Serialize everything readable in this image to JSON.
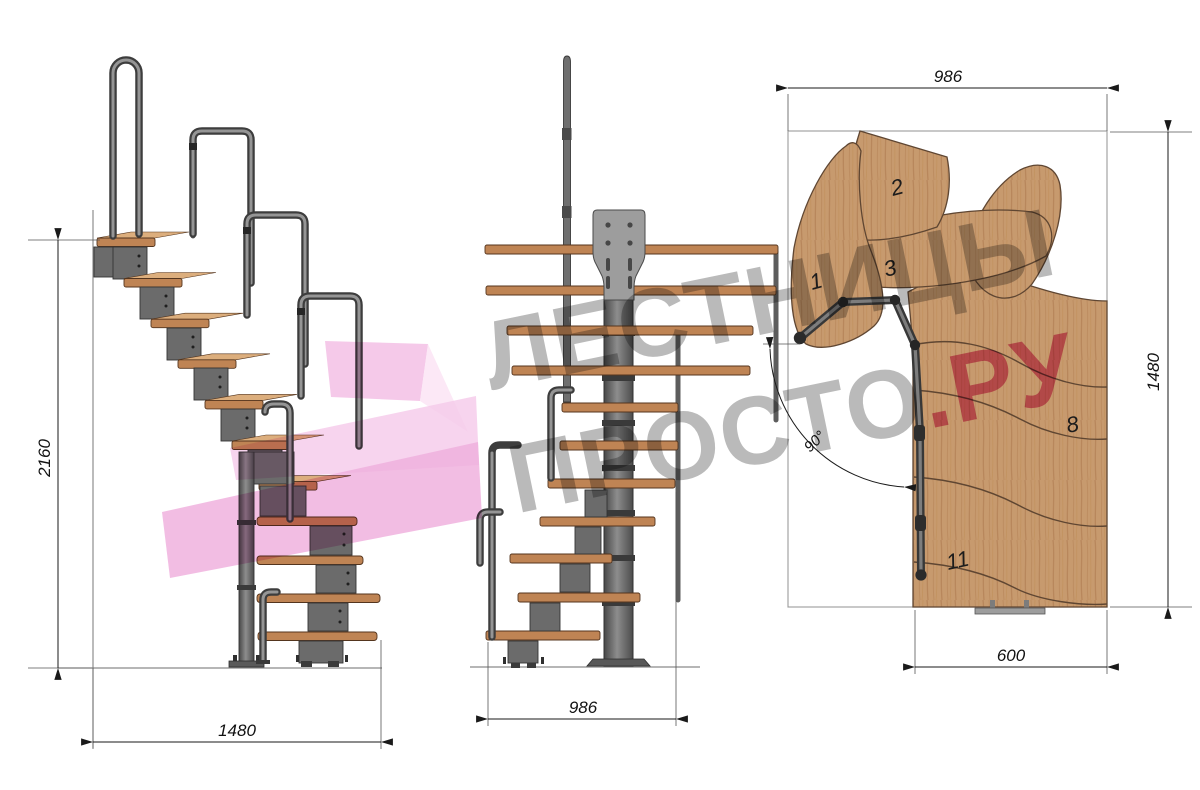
{
  "watermark": {
    "line1": "ЛЕСТНИЦЫ",
    "line2": "ПРОСТО",
    "line2_accent": ".РУ"
  },
  "dimensions": {
    "side_height": "2160",
    "side_run": "1480",
    "front_width": "986",
    "plan_width": "986",
    "plan_depth": "1480",
    "flight_width": "600",
    "turn_angle": "90°"
  },
  "plan_labels": {
    "step1": "1",
    "step2": "2",
    "step3": "3",
    "step8": "8",
    "step11": "11"
  },
  "colors": {
    "wood_elevation": "#bf8454",
    "wood_plan": "#c79a6e",
    "metal": "#6b6b6b",
    "metal_dark": "#3d3d3d",
    "watermark_gray": "#7a7a7a",
    "watermark_pink": "#d83e80",
    "arrow_pink": "#f0b2de",
    "dimension_ink": "#1a1a1a"
  }
}
